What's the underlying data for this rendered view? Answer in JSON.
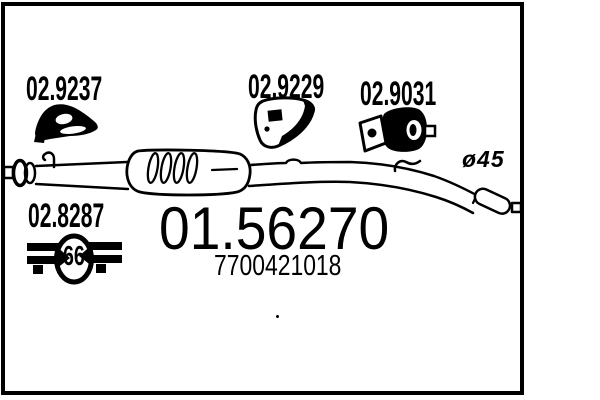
{
  "palette": {
    "ink": "#000000",
    "paper": "#ffffff"
  },
  "codes": {
    "top_left": "02.9237",
    "top_center": "02.9229",
    "top_right": "02.9031",
    "bottom_left": "02.8287",
    "clamp_size": "66",
    "diameter": "ø45",
    "main": "01.56270",
    "oem": "7700421018"
  },
  "icons": {
    "top_left": "rubber-hanger-icon",
    "top_center": "mounting-bracket-icon",
    "top_right": "pipe-clamp-icon",
    "bottom_left": "band-clamp-66-icon"
  },
  "drawing": "exhaust-centre-silencer-line-art"
}
